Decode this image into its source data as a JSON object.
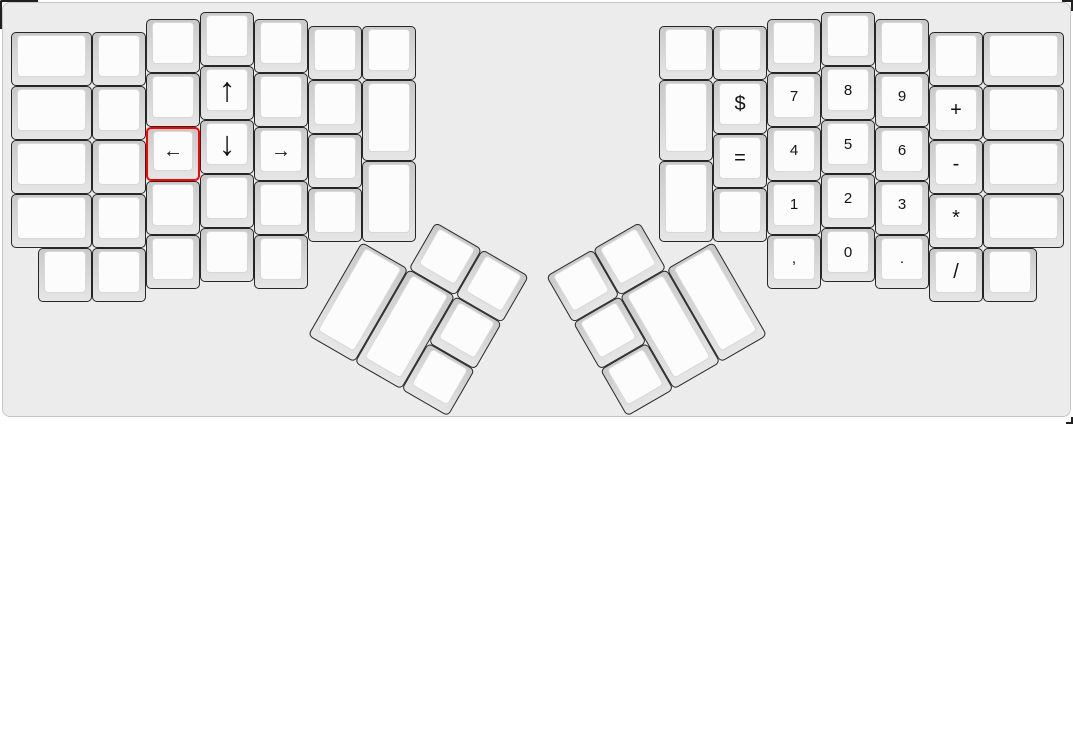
{
  "app": {
    "description": "keyboard layout editor canvas showing a split ergonomic (ErgoDox) keyboard",
    "selected_key": "left-arrow"
  },
  "style": {
    "page_bg": "#ffffff",
    "canvas_bg": "#ececec",
    "canvas_border": "#c6c6c6",
    "key_border": "#262626",
    "key_base_top": "#c9c9c9",
    "key_base_bottom": "#e6e6e6",
    "key_cap": "#fcfcfc",
    "key_cap_border": "#d8d8d8",
    "legend_color": "#141414",
    "selected_border": "#ff0000"
  },
  "layout": {
    "unit_px": 54,
    "origin_x_px": 8,
    "origin_y_px": 9,
    "clusters": {
      "lm": {
        "name": "left-main-block",
        "rotation_deg": 0
      },
      "lt": {
        "name": "left-thumb-cluster",
        "rotation_deg": 30,
        "origin_u": [
          6.5,
          4.25
        ]
      },
      "rt": {
        "name": "right-thumb-cluster",
        "rotation_deg": -30,
        "origin_u": [
          13,
          4.25
        ]
      },
      "rm": {
        "name": "right-main-block",
        "rotation_deg": 0
      }
    },
    "keys": [
      {
        "n": "blank",
        "g": "lm",
        "x": 0,
        "y": 0.375,
        "w": 1.5,
        "h": 1
      },
      {
        "n": "blank",
        "g": "lm",
        "x": 0,
        "y": 1.375,
        "w": 1.5,
        "h": 1
      },
      {
        "n": "blank",
        "g": "lm",
        "x": 0,
        "y": 2.375,
        "w": 1.5,
        "h": 1
      },
      {
        "n": "blank",
        "g": "lm",
        "x": 0,
        "y": 3.375,
        "w": 1.5,
        "h": 1
      },
      {
        "n": "blank",
        "g": "lm",
        "x": 1.5,
        "y": 0.375,
        "w": 1,
        "h": 1
      },
      {
        "n": "blank",
        "g": "lm",
        "x": 1.5,
        "y": 1.375,
        "w": 1,
        "h": 1
      },
      {
        "n": "blank",
        "g": "lm",
        "x": 1.5,
        "y": 2.375,
        "w": 1,
        "h": 1
      },
      {
        "n": "blank",
        "g": "lm",
        "x": 1.5,
        "y": 3.375,
        "w": 1,
        "h": 1
      },
      {
        "n": "blank",
        "g": "lm",
        "x": 2.5,
        "y": 0.125,
        "w": 1,
        "h": 1
      },
      {
        "n": "blank",
        "g": "lm",
        "x": 2.5,
        "y": 1.125,
        "w": 1,
        "h": 1
      },
      {
        "n": "left-arrow",
        "g": "lm",
        "x": 2.5,
        "y": 2.125,
        "w": 1,
        "h": 1,
        "l": "←",
        "f": 20,
        "sel": true
      },
      {
        "n": "blank",
        "g": "lm",
        "x": 2.5,
        "y": 3.125,
        "w": 1,
        "h": 1
      },
      {
        "n": "blank",
        "g": "lm",
        "x": 3.5,
        "y": 0,
        "w": 1,
        "h": 1
      },
      {
        "n": "up-arrow",
        "g": "lm",
        "x": 3.5,
        "y": 1,
        "w": 1,
        "h": 1,
        "l": "↑",
        "f": 34
      },
      {
        "n": "down-arrow",
        "g": "lm",
        "x": 3.5,
        "y": 2,
        "w": 1,
        "h": 1,
        "l": "↓",
        "f": 34
      },
      {
        "n": "blank",
        "g": "lm",
        "x": 3.5,
        "y": 3,
        "w": 1,
        "h": 1
      },
      {
        "n": "blank",
        "g": "lm",
        "x": 4.5,
        "y": 0.125,
        "w": 1,
        "h": 1
      },
      {
        "n": "blank",
        "g": "lm",
        "x": 4.5,
        "y": 1.125,
        "w": 1,
        "h": 1
      },
      {
        "n": "right-arrow",
        "g": "lm",
        "x": 4.5,
        "y": 2.125,
        "w": 1,
        "h": 1,
        "l": "→",
        "f": 20
      },
      {
        "n": "blank",
        "g": "lm",
        "x": 4.5,
        "y": 3.125,
        "w": 1,
        "h": 1
      },
      {
        "n": "blank",
        "g": "lm",
        "x": 5.5,
        "y": 0.25,
        "w": 1,
        "h": 1
      },
      {
        "n": "blank",
        "g": "lm",
        "x": 5.5,
        "y": 1.25,
        "w": 1,
        "h": 1
      },
      {
        "n": "blank",
        "g": "lm",
        "x": 5.5,
        "y": 2.25,
        "w": 1,
        "h": 1
      },
      {
        "n": "blank",
        "g": "lm",
        "x": 5.5,
        "y": 3.25,
        "w": 1,
        "h": 1
      },
      {
        "n": "blank",
        "g": "lm",
        "x": 6.5,
        "y": 0.25,
        "w": 1,
        "h": 1
      },
      {
        "n": "blank",
        "g": "lm",
        "x": 6.5,
        "y": 1.25,
        "w": 1,
        "h": 1.5
      },
      {
        "n": "blank",
        "g": "lm",
        "x": 6.5,
        "y": 2.75,
        "w": 1,
        "h": 1.5
      },
      {
        "n": "blank",
        "g": "lm",
        "x": 0.5,
        "y": 4.375,
        "w": 1,
        "h": 1
      },
      {
        "n": "blank",
        "g": "lm",
        "x": 1.5,
        "y": 4.375,
        "w": 1,
        "h": 1
      },
      {
        "n": "blank",
        "g": "lm",
        "x": 2.5,
        "y": 4.125,
        "w": 1,
        "h": 1
      },
      {
        "n": "blank",
        "g": "lm",
        "x": 3.5,
        "y": 4,
        "w": 1,
        "h": 1
      },
      {
        "n": "blank",
        "g": "lm",
        "x": 4.5,
        "y": 4.125,
        "w": 1,
        "h": 1
      },
      {
        "n": "blank",
        "g": "lt",
        "x": 7.5,
        "y": 3.25,
        "w": 1,
        "h": 1
      },
      {
        "n": "blank",
        "g": "lt",
        "x": 8.5,
        "y": 3.25,
        "w": 1,
        "h": 1
      },
      {
        "n": "blank",
        "g": "lt",
        "x": 6.5,
        "y": 4.25,
        "w": 1,
        "h": 2
      },
      {
        "n": "blank",
        "g": "lt",
        "x": 7.5,
        "y": 4.25,
        "w": 1,
        "h": 2
      },
      {
        "n": "blank",
        "g": "lt",
        "x": 8.5,
        "y": 4.25,
        "w": 1,
        "h": 1
      },
      {
        "n": "blank",
        "g": "lt",
        "x": 8.5,
        "y": 5.25,
        "w": 1,
        "h": 1
      },
      {
        "n": "blank",
        "g": "rt",
        "x": 10,
        "y": 3.25,
        "w": 1,
        "h": 1
      },
      {
        "n": "blank",
        "g": "rt",
        "x": 11,
        "y": 3.25,
        "w": 1,
        "h": 1
      },
      {
        "n": "blank",
        "g": "rt",
        "x": 10,
        "y": 4.25,
        "w": 1,
        "h": 1
      },
      {
        "n": "blank",
        "g": "rt",
        "x": 11,
        "y": 4.25,
        "w": 1,
        "h": 2
      },
      {
        "n": "blank",
        "g": "rt",
        "x": 12,
        "y": 4.25,
        "w": 1,
        "h": 2
      },
      {
        "n": "blank",
        "g": "rt",
        "x": 10,
        "y": 5.25,
        "w": 1,
        "h": 1
      },
      {
        "n": "blank",
        "g": "rm",
        "x": 12,
        "y": 0.25,
        "w": 1,
        "h": 1
      },
      {
        "n": "blank",
        "g": "rm",
        "x": 12,
        "y": 1.25,
        "w": 1,
        "h": 1.5
      },
      {
        "n": "blank",
        "g": "rm",
        "x": 12,
        "y": 2.75,
        "w": 1,
        "h": 1.5
      },
      {
        "n": "blank",
        "g": "rm",
        "x": 13,
        "y": 0.25,
        "w": 1,
        "h": 1
      },
      {
        "n": "dollar",
        "g": "rm",
        "x": 13,
        "y": 1.25,
        "w": 1,
        "h": 1,
        "l": "$",
        "f": 20
      },
      {
        "n": "equals",
        "g": "rm",
        "x": 13,
        "y": 2.25,
        "w": 1,
        "h": 1,
        "l": "=",
        "f": 20
      },
      {
        "n": "blank",
        "g": "rm",
        "x": 13,
        "y": 3.25,
        "w": 1,
        "h": 1
      },
      {
        "n": "blank",
        "g": "rm",
        "x": 14,
        "y": 0.125,
        "w": 1,
        "h": 1
      },
      {
        "n": "7",
        "g": "rm",
        "x": 14,
        "y": 1.125,
        "w": 1,
        "h": 1,
        "l": "7",
        "f": 15
      },
      {
        "n": "4",
        "g": "rm",
        "x": 14,
        "y": 2.125,
        "w": 1,
        "h": 1,
        "l": "4",
        "f": 15
      },
      {
        "n": "1",
        "g": "rm",
        "x": 14,
        "y": 3.125,
        "w": 1,
        "h": 1,
        "l": "1",
        "f": 15
      },
      {
        "n": "comma",
        "g": "rm",
        "x": 14,
        "y": 4.125,
        "w": 1,
        "h": 1,
        "l": ",",
        "f": 15
      },
      {
        "n": "blank",
        "g": "rm",
        "x": 15,
        "y": 0,
        "w": 1,
        "h": 1
      },
      {
        "n": "8",
        "g": "rm",
        "x": 15,
        "y": 1,
        "w": 1,
        "h": 1,
        "l": "8",
        "f": 15
      },
      {
        "n": "5",
        "g": "rm",
        "x": 15,
        "y": 2,
        "w": 1,
        "h": 1,
        "l": "5",
        "f": 15
      },
      {
        "n": "2",
        "g": "rm",
        "x": 15,
        "y": 3,
        "w": 1,
        "h": 1,
        "l": "2",
        "f": 15
      },
      {
        "n": "0",
        "g": "rm",
        "x": 15,
        "y": 4,
        "w": 1,
        "h": 1,
        "l": "0",
        "f": 15
      },
      {
        "n": "blank",
        "g": "rm",
        "x": 16,
        "y": 0.125,
        "w": 1,
        "h": 1
      },
      {
        "n": "9",
        "g": "rm",
        "x": 16,
        "y": 1.125,
        "w": 1,
        "h": 1,
        "l": "9",
        "f": 15
      },
      {
        "n": "6",
        "g": "rm",
        "x": 16,
        "y": 2.125,
        "w": 1,
        "h": 1,
        "l": "6",
        "f": 15
      },
      {
        "n": "3",
        "g": "rm",
        "x": 16,
        "y": 3.125,
        "w": 1,
        "h": 1,
        "l": "3",
        "f": 15
      },
      {
        "n": "period",
        "g": "rm",
        "x": 16,
        "y": 4.125,
        "w": 1,
        "h": 1,
        "l": ".",
        "f": 15
      },
      {
        "n": "blank",
        "g": "rm",
        "x": 17,
        "y": 0.375,
        "w": 1,
        "h": 1
      },
      {
        "n": "plus",
        "g": "rm",
        "x": 17,
        "y": 1.375,
        "w": 1,
        "h": 1,
        "l": "+",
        "f": 20
      },
      {
        "n": "minus",
        "g": "rm",
        "x": 17,
        "y": 2.375,
        "w": 1,
        "h": 1,
        "l": "-",
        "f": 20
      },
      {
        "n": "asterisk",
        "g": "rm",
        "x": 17,
        "y": 3.375,
        "w": 1,
        "h": 1,
        "l": "*",
        "f": 20
      },
      {
        "n": "slash",
        "g": "rm",
        "x": 17,
        "y": 4.375,
        "w": 1,
        "h": 1,
        "l": "/",
        "f": 20
      },
      {
        "n": "blank",
        "g": "rm",
        "x": 18,
        "y": 0.375,
        "w": 1.5,
        "h": 1
      },
      {
        "n": "blank",
        "g": "rm",
        "x": 18,
        "y": 1.375,
        "w": 1.5,
        "h": 1
      },
      {
        "n": "blank",
        "g": "rm",
        "x": 18,
        "y": 2.375,
        "w": 1.5,
        "h": 1
      },
      {
        "n": "blank",
        "g": "rm",
        "x": 18,
        "y": 3.375,
        "w": 1.5,
        "h": 1
      },
      {
        "n": "blank",
        "g": "rm",
        "x": 18,
        "y": 4.375,
        "w": 1,
        "h": 1
      }
    ]
  }
}
